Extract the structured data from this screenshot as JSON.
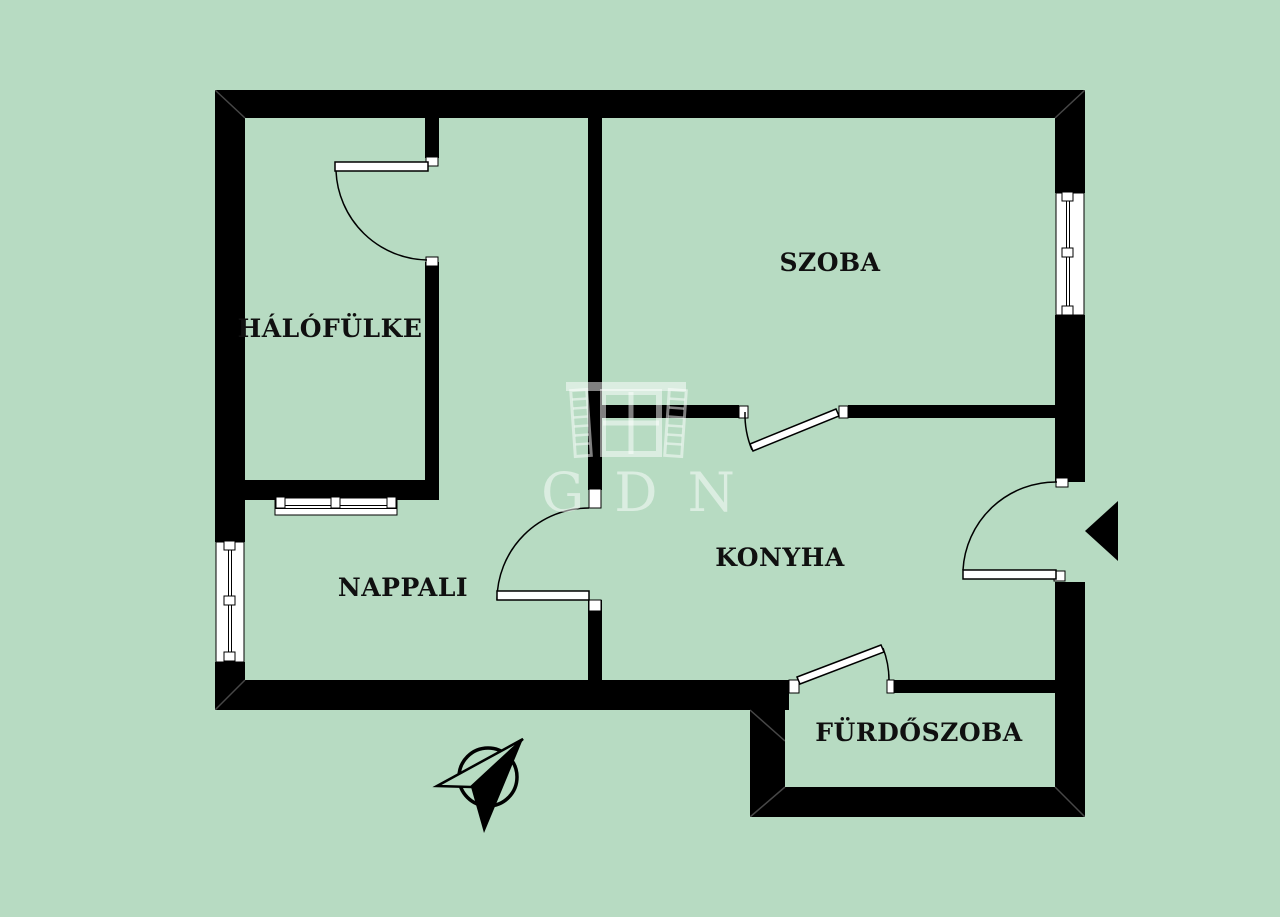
{
  "colors": {
    "background": "#b7dbc2",
    "wall": "#000000",
    "line": "#000000",
    "window_fill": "#ffffff",
    "watermark": "rgba(255,255,255,0.5)",
    "label": "#101010"
  },
  "rooms": [
    {
      "id": "halofulke",
      "label": "HÁLÓFÜLKE"
    },
    {
      "id": "szoba",
      "label": "SZOBA"
    },
    {
      "id": "nappali",
      "label": "NAPPALI"
    },
    {
      "id": "konyha",
      "label": "KONYHA"
    },
    {
      "id": "furdoszoba",
      "label": "FÜRDŐSZOBA"
    }
  ],
  "watermark": {
    "text": "GDN"
  },
  "icons": {
    "compass": "north-compass-icon",
    "entrance": "entrance-arrow-icon",
    "logo": "gdn-building-logo-icon"
  }
}
